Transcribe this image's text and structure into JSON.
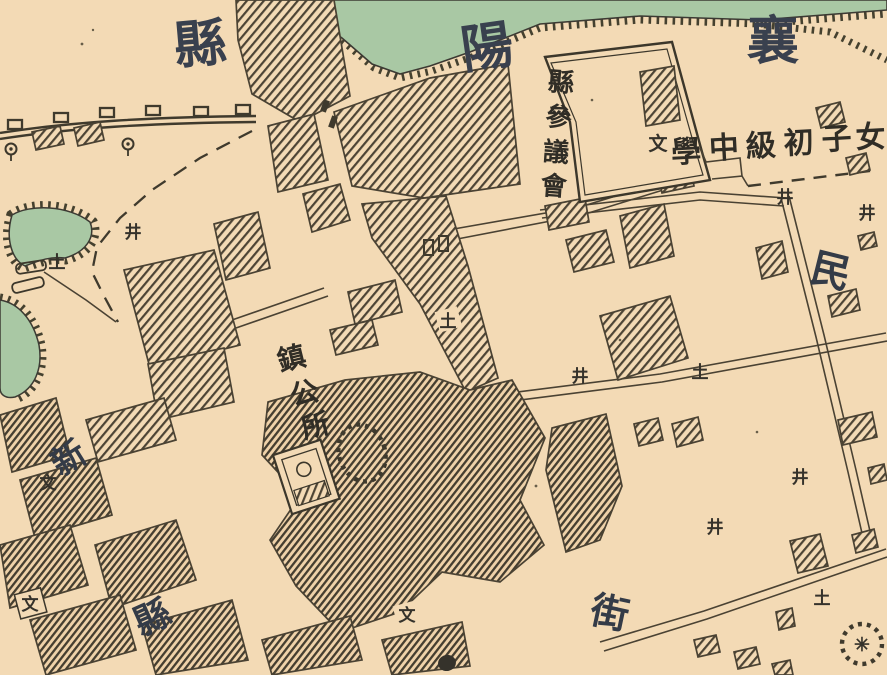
{
  "map": {
    "place_name": {
      "reading": "襄陽縣",
      "char_1": "襄",
      "char_2": "陽",
      "char_3": "縣"
    },
    "pois": {
      "county_council": {
        "reading": "縣參議會",
        "chars": [
          "縣",
          "參",
          "議",
          "會"
        ]
      },
      "girls_school": {
        "reading": "女子初級中學",
        "chars": [
          "學",
          "中",
          "級",
          "初",
          "子",
          "女"
        ],
        "marker": "文"
      },
      "town_office": {
        "reading": "鎮公所",
        "chars": [
          "鎮",
          "公",
          "所"
        ]
      }
    },
    "street_labels": {
      "jie": "街",
      "min": "民",
      "xian": "縣",
      "xin": "新"
    },
    "markers": {
      "earth_mound": "土",
      "well": "井",
      "school": "文",
      "shrine_star": "✳"
    },
    "colors": {
      "paper": "#f3dab5",
      "water": "#a9c8a4",
      "ink": "#46402f",
      "hatch": "#4d4435",
      "big_label": "#39404e",
      "small_label": "#302d26"
    }
  }
}
